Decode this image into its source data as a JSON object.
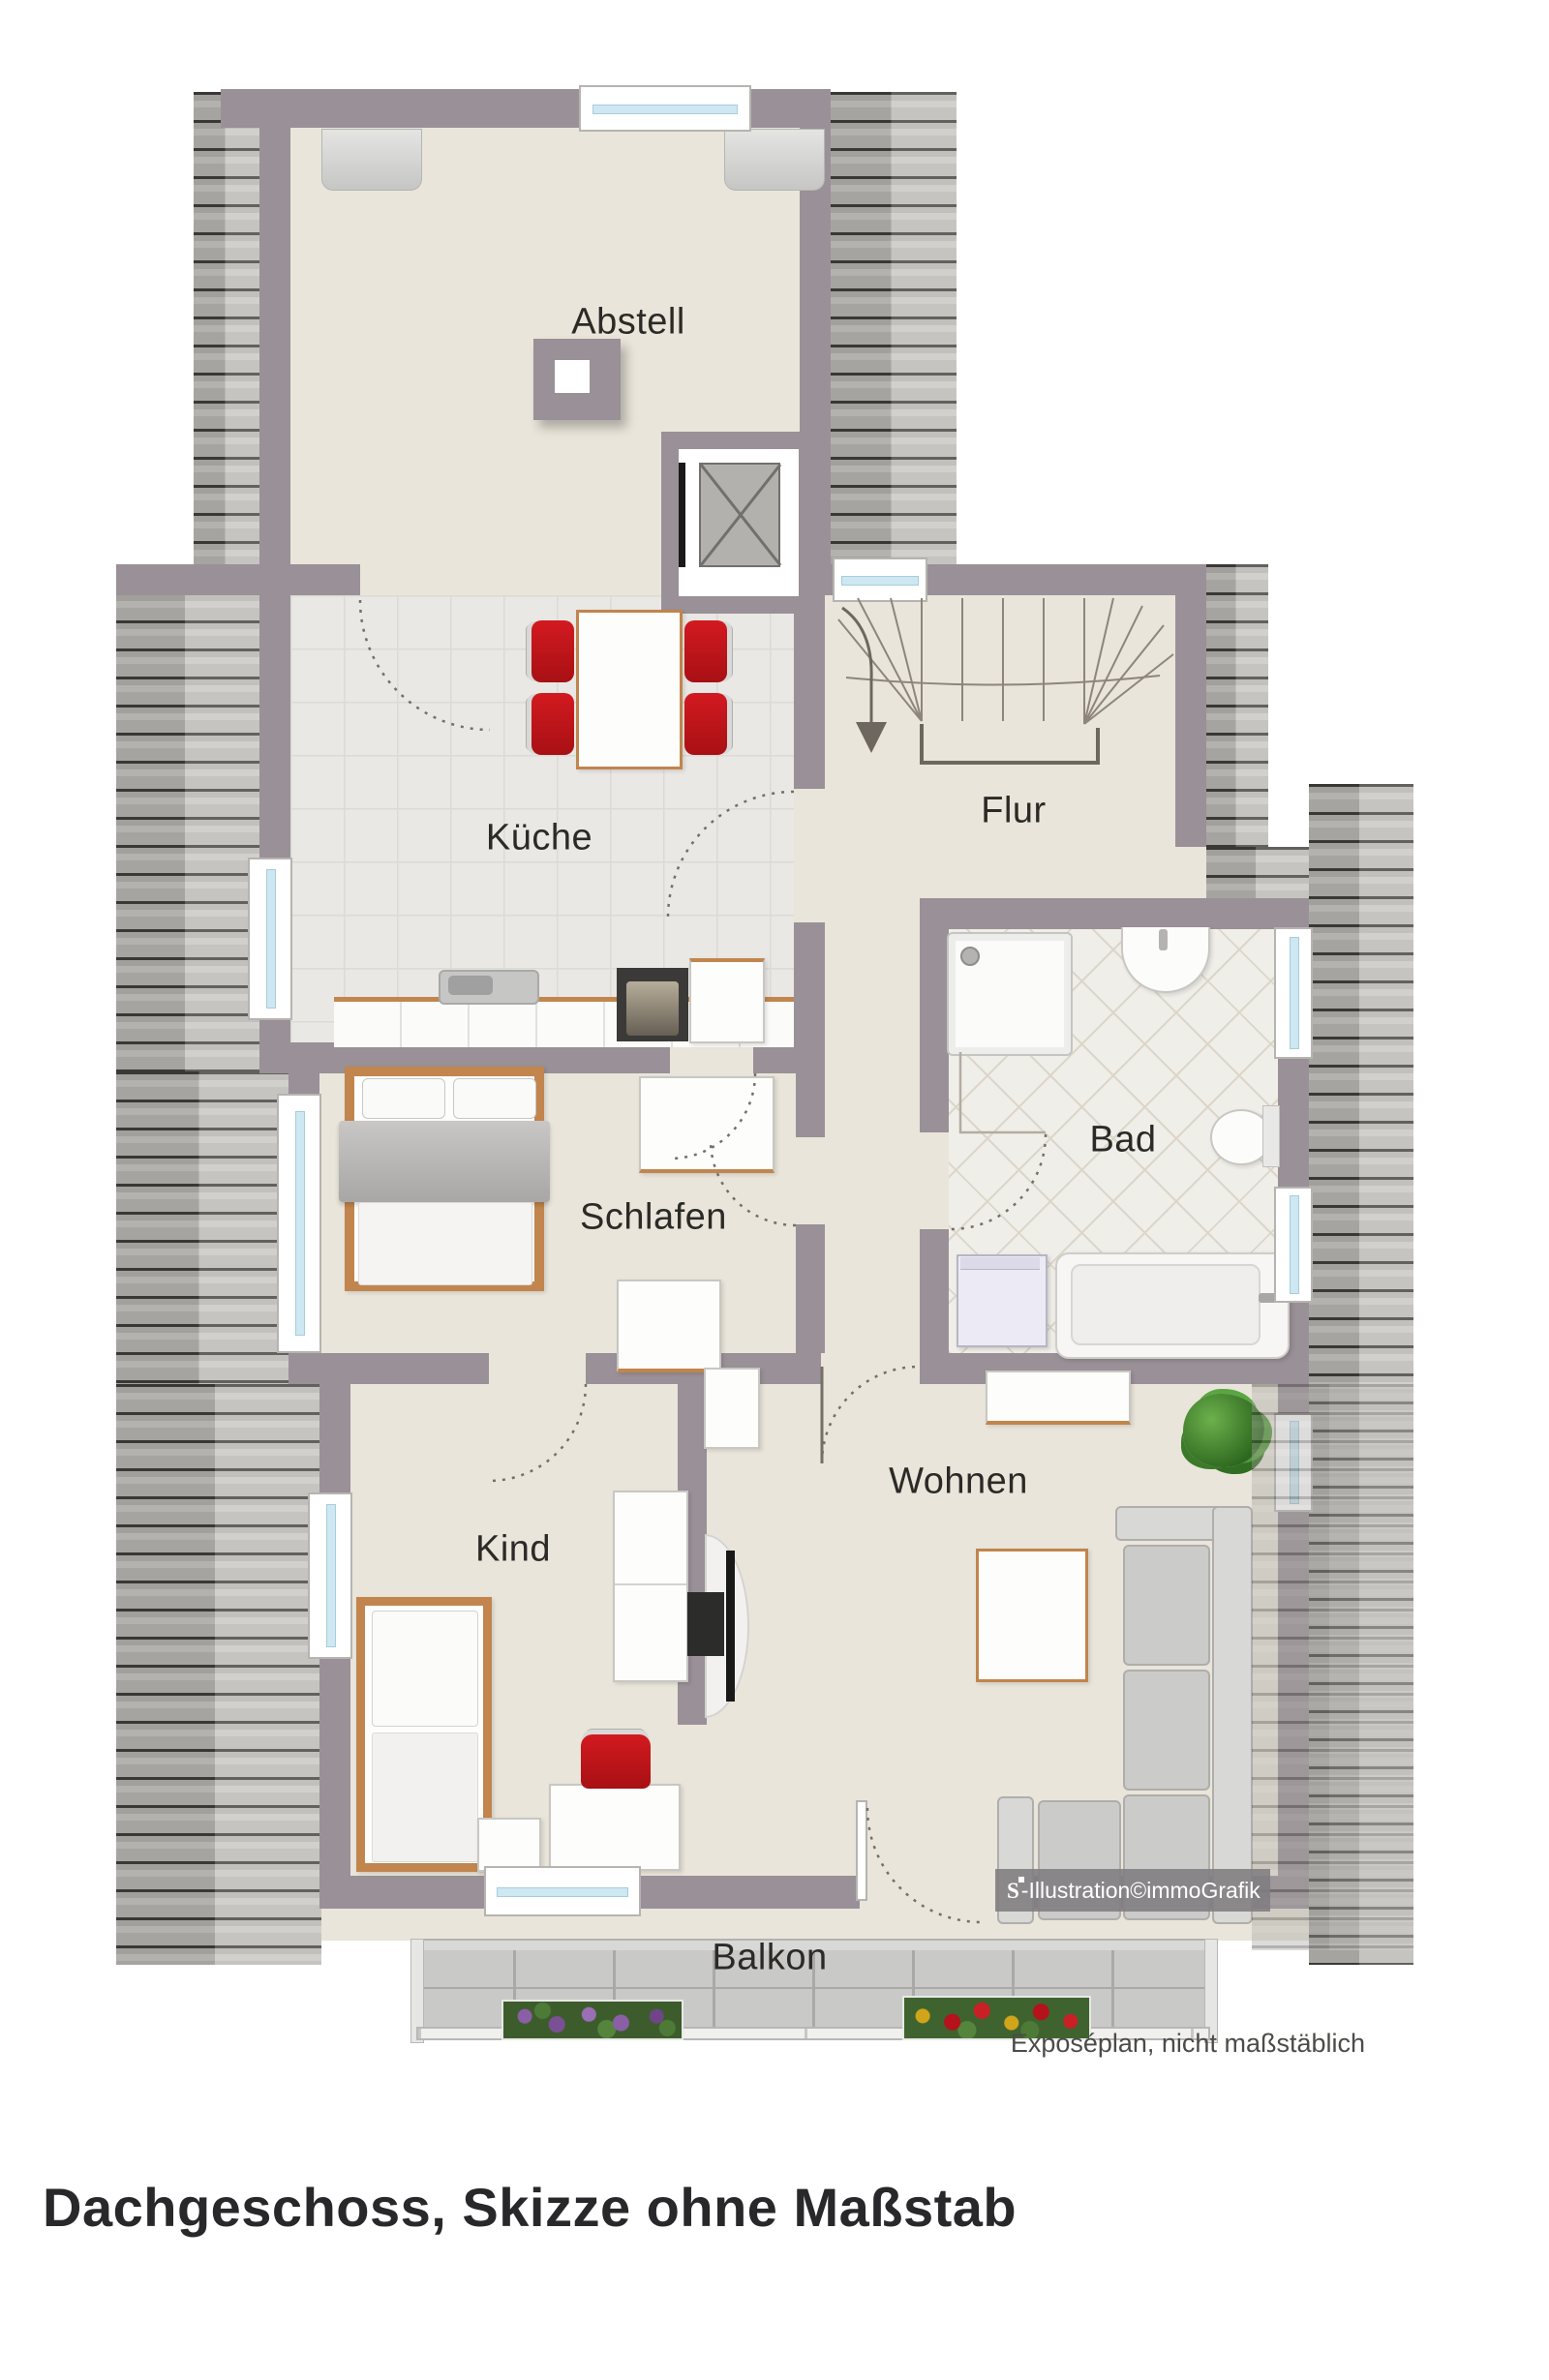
{
  "title": "Dachgeschoss, Skizze ohne Maßstab",
  "plan": {
    "type": "floor-plan",
    "rooms": {
      "abstell": "Abstell",
      "kueche": "Küche",
      "flur": "Flur",
      "bad": "Bad",
      "schlafen": "Schlafen",
      "wohnen": "Wohnen",
      "kind": "Kind",
      "balkon": "Balkon"
    },
    "watermark": {
      "logo": "S",
      "text": "-Illustration©immoGrafik"
    },
    "caption": "Exposéplan, nicht maßstäblich",
    "colors": {
      "wall": "#9a9097",
      "floor": "#e9e5da",
      "kitchen_tile": "#e9e8e4",
      "bath_tile": "#f0eee8",
      "roof_hatch": "#c6c4c0",
      "accent_red": "#c4161c",
      "wood": "#c1854d",
      "sofa_gray": "#cbcbc9",
      "plant_green": "#4c9334",
      "window_glass": "#cde8f2",
      "balcony_tile": "#c9c9c7",
      "label_text": "#2b2a27"
    }
  }
}
